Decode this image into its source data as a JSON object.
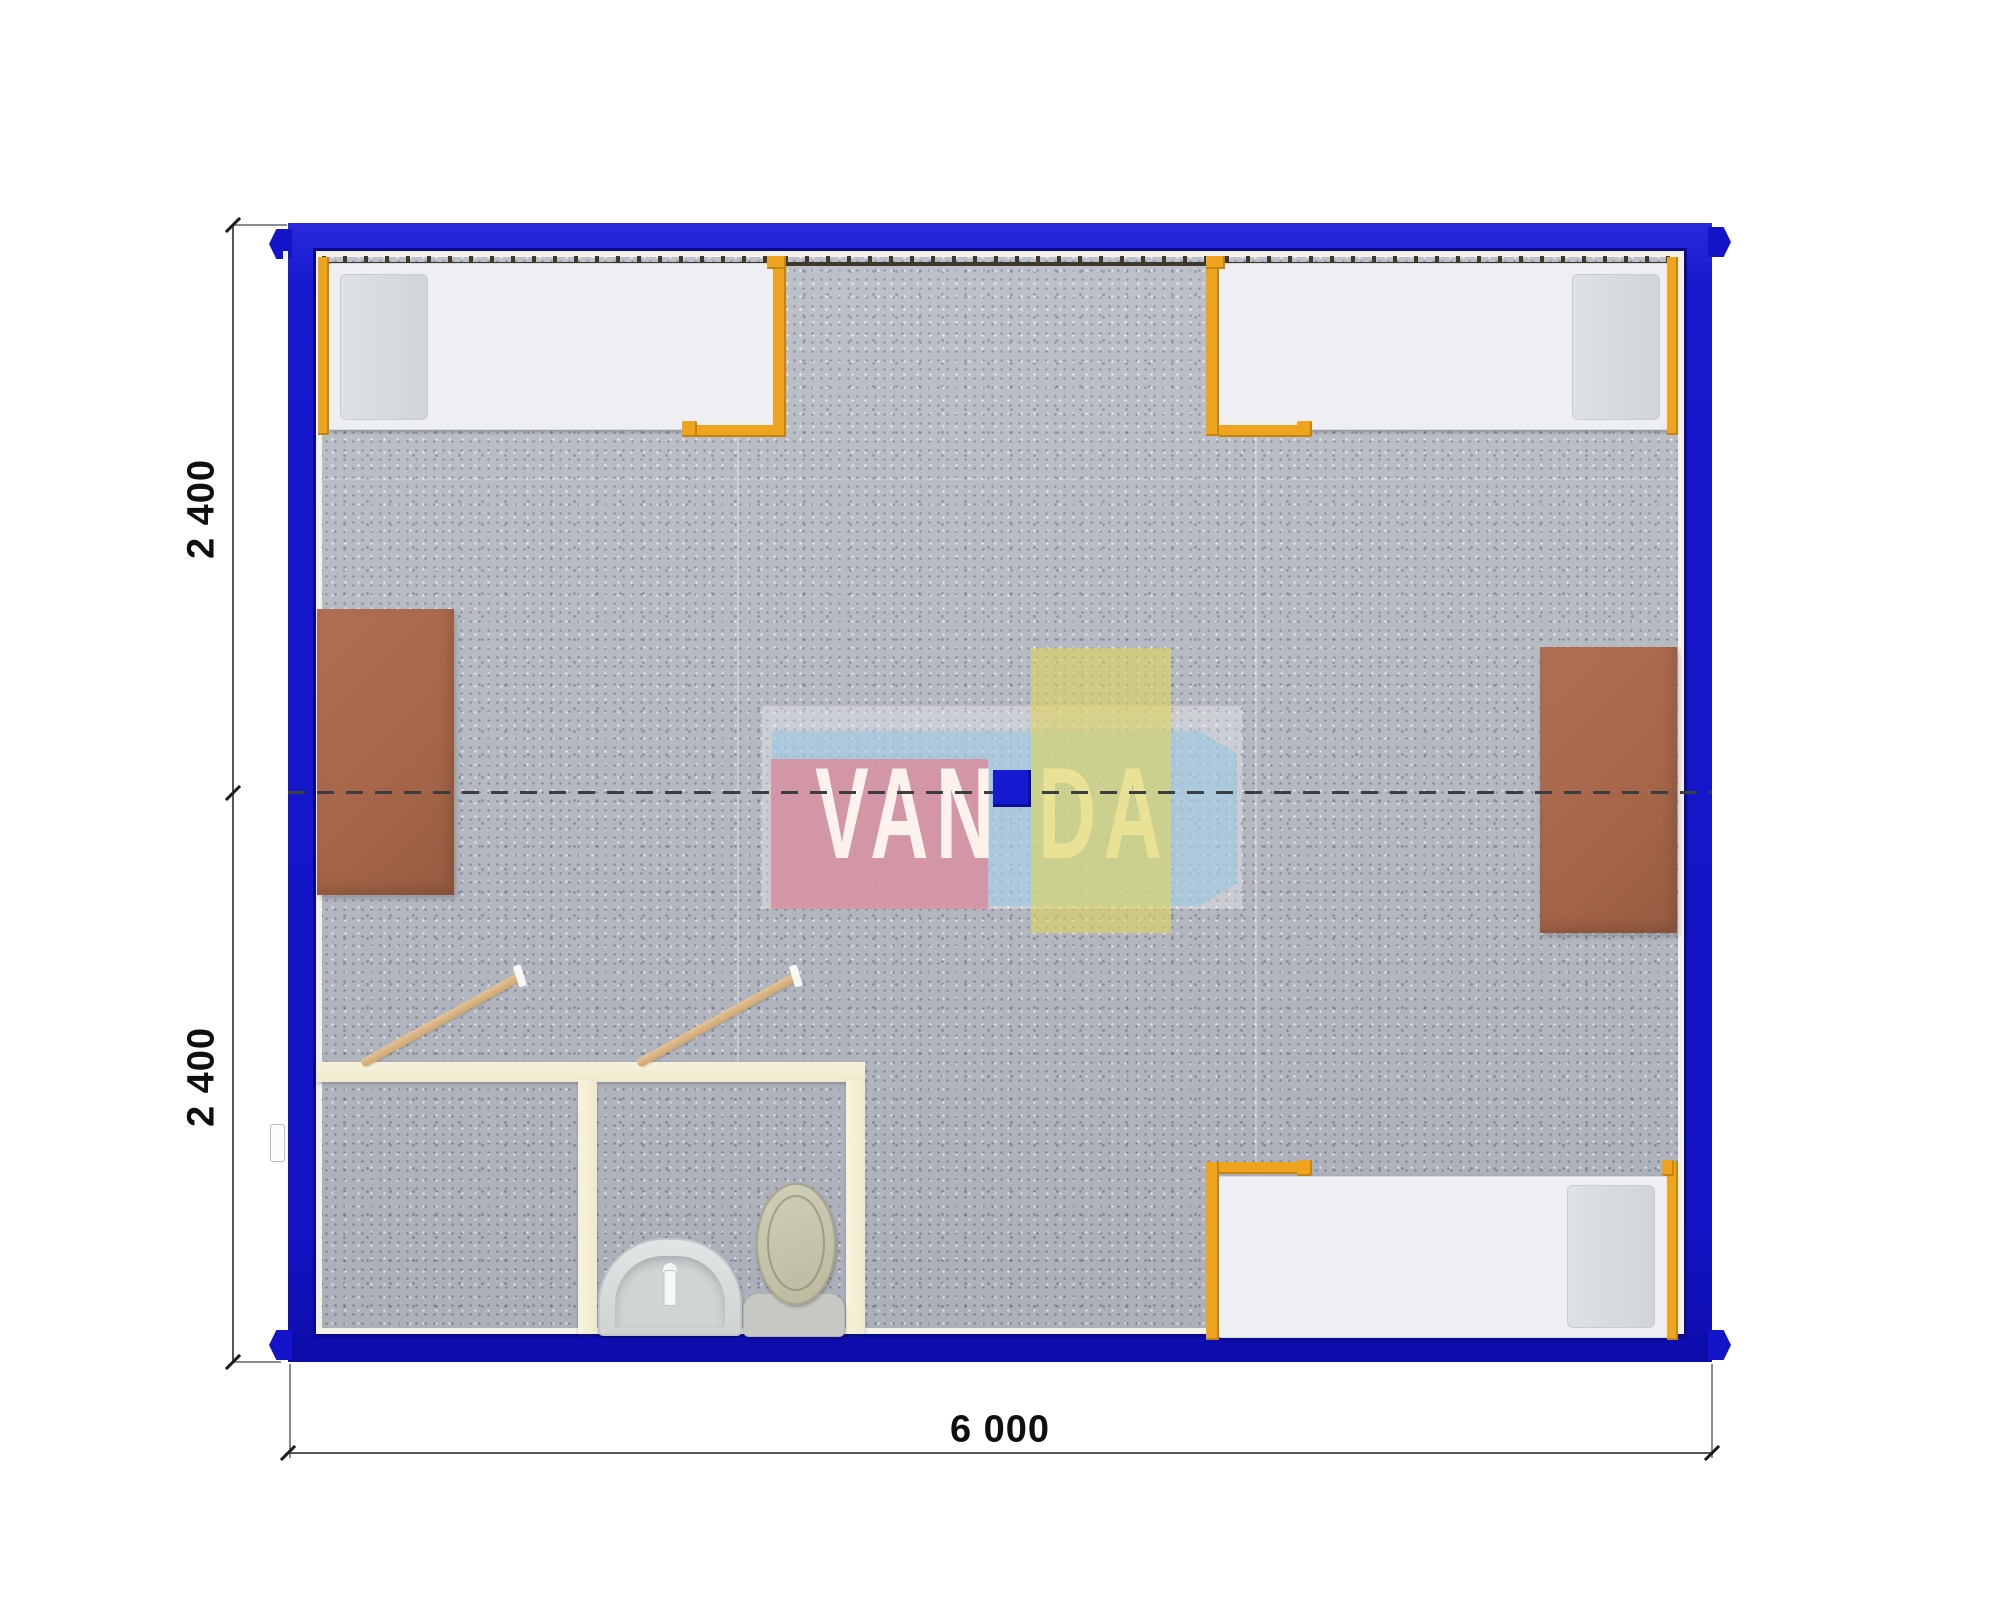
{
  "document": {
    "type": "container-house-floor-plan"
  },
  "dimensions": {
    "left_top": "2 400",
    "left_bottom": "2 400",
    "bottom": "6 000"
  },
  "watermark": {
    "van": "VAN",
    "da": "DA"
  },
  "colors": {
    "frame_blue": "#1414c9",
    "frame_inner_navy": "#090a8e",
    "floor_gray": "#b5b9c3",
    "bed_mattress_white": "#edeff2",
    "bed_frame_orange": "#eea41e",
    "desk_brown": "#a76649",
    "bathroom_wall_cream": "#f4efd8",
    "fixture_gray": "#d8dcdc",
    "toilet_olive": "#c9c7ae",
    "door_wood_tan": "#d9b88a",
    "dashed_axis": "#3b3d41",
    "dimension_text": "#0f0f0f",
    "watermark_pink": "#dd8a98",
    "watermark_yellow": "#ded65c",
    "watermark_sky_blue": "#94c4e2",
    "watermark_blue_box": "#151bd0"
  },
  "furniture": [
    "bed-top-left",
    "bed-top-right",
    "bed-bottom-right",
    "desk-left",
    "desk-right",
    "washbasin",
    "toilet",
    "door-swing-left",
    "door-swing-right"
  ]
}
